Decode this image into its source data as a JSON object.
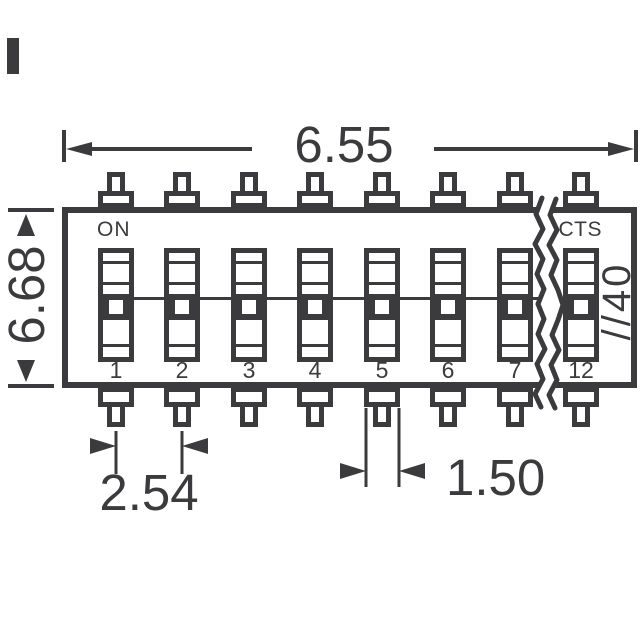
{
  "drawing": {
    "type": "DIP switch dimensional drawing",
    "labels": {
      "on": "ON",
      "brand": "CTS",
      "side_marking": "//40"
    },
    "dimensions": {
      "top_width": "6.55",
      "left_height": "6.68",
      "pin_pitch": "2.54",
      "terminal_width": "1.50"
    },
    "switches": [
      "1",
      "2",
      "3",
      "4",
      "5",
      "6",
      "7",
      "12"
    ],
    "colors": {
      "ink": "#3b3b3d",
      "background": "#ffffff"
    }
  }
}
